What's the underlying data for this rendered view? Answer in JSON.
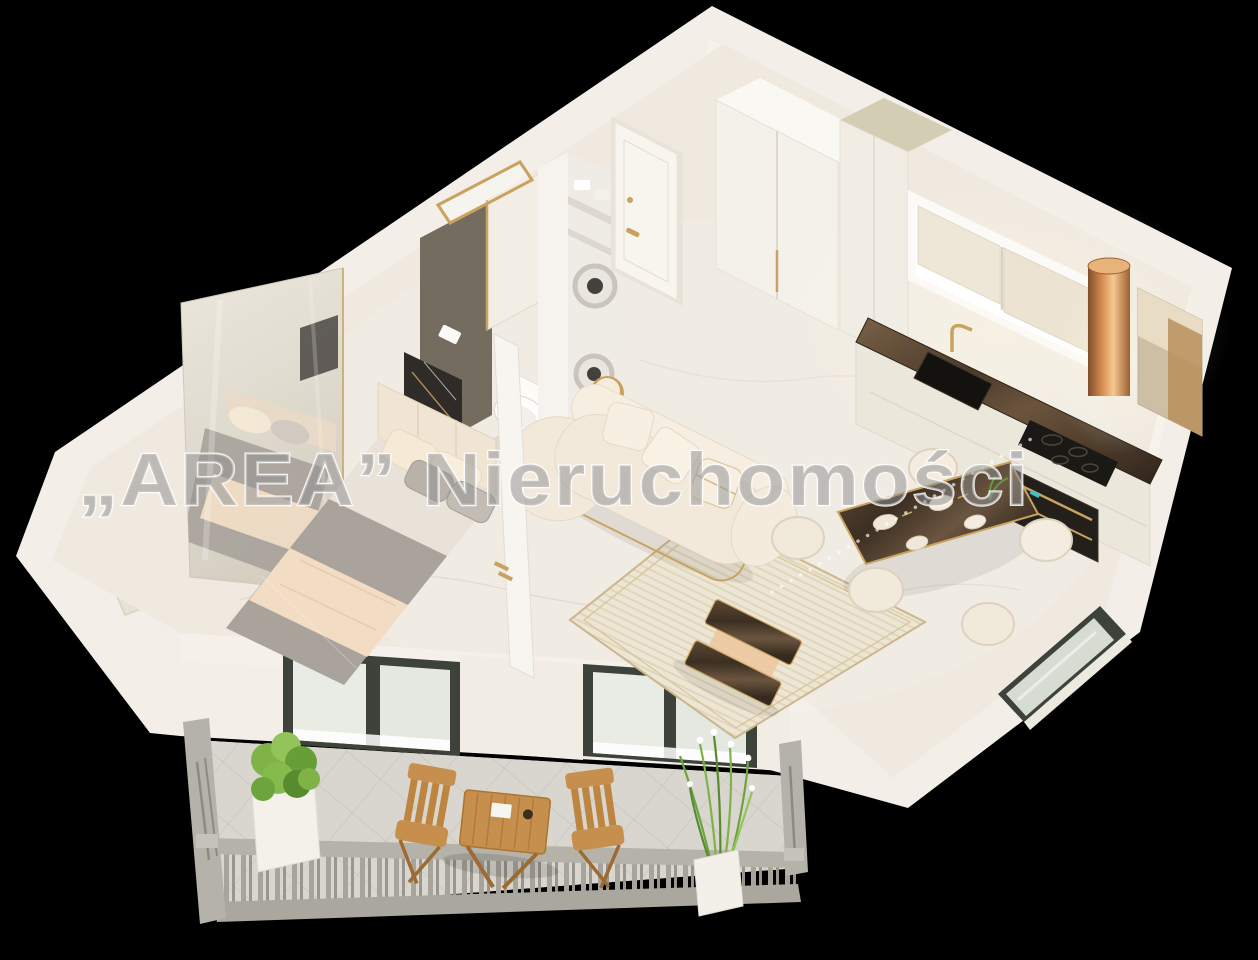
{
  "watermark": {
    "text": "„AREA” Nieruchomości"
  },
  "scene": {
    "kind": "3d-isometric-apartment-floor-plan-render",
    "background": "#000000",
    "rooms": [
      {
        "name": "bedroom",
        "furniture": [
          "double-bed",
          "upholstered-headboard",
          "dark-art-panel",
          "mirror-wardrobe",
          "glass-partition"
        ]
      },
      {
        "name": "bathroom",
        "furniture": [
          "wall-hung-toilet",
          "flush-plate",
          "washer-dryer-stack",
          "storage-shelves",
          "marble-shower-panel",
          "gold-framed-shower-screen"
        ]
      },
      {
        "name": "hallway",
        "furniture": [
          "entry-door",
          "built-in-closet"
        ]
      },
      {
        "name": "kitchen",
        "furniture": [
          "tall-cabinets",
          "window-with-roller-blinds",
          "dark-marble-countertop",
          "black-sink",
          "gold-faucet",
          "induction-hob",
          "built-in-oven",
          "copper-range-hood",
          "bronze-mirror-cabinet"
        ]
      },
      {
        "name": "living-room",
        "furniture": [
          "curved-boucle-sofa",
          "striped-area-rug",
          "marble-coffee-table",
          "gold-side-table"
        ]
      },
      {
        "name": "dining-area",
        "furniture": [
          "marble-dining-table",
          "cream-tub-chairs",
          "table-settings",
          "plant-sprig"
        ]
      },
      {
        "name": "balcony",
        "furniture": [
          "stone-balustrade",
          "diagonal-tiled-floor",
          "wooden-bistro-table",
          "wooden-folding-chairs",
          "planter-box-shrub",
          "planter-box-flower-grass"
        ]
      }
    ]
  },
  "palette": {
    "bg": "#000000",
    "wall": "#f3efe8",
    "wall_face": "#f8f4ed",
    "floor": "#efe9e0",
    "accent_wall": "#746c5f",
    "cream": "#f2e9db",
    "white_furniture": "#fbfaf6",
    "gray_textile": "#a9a39c",
    "throw_blanket": "#f2dcc3",
    "gold": "#c9a25f",
    "window_frame": "#3d433b",
    "window_glass": "#d7dcd3",
    "stone": "#b5b2a9",
    "stone_dark": "#9b988f",
    "wood": "#c68f4d",
    "wood_dark": "#9c6b33",
    "plant_green": "#7fb347",
    "plant_dark": "#578c2e",
    "marble_counter_dark": "#4a3a2a",
    "copper": "#d98f52",
    "watermark_fill": "#8f8f8f"
  }
}
